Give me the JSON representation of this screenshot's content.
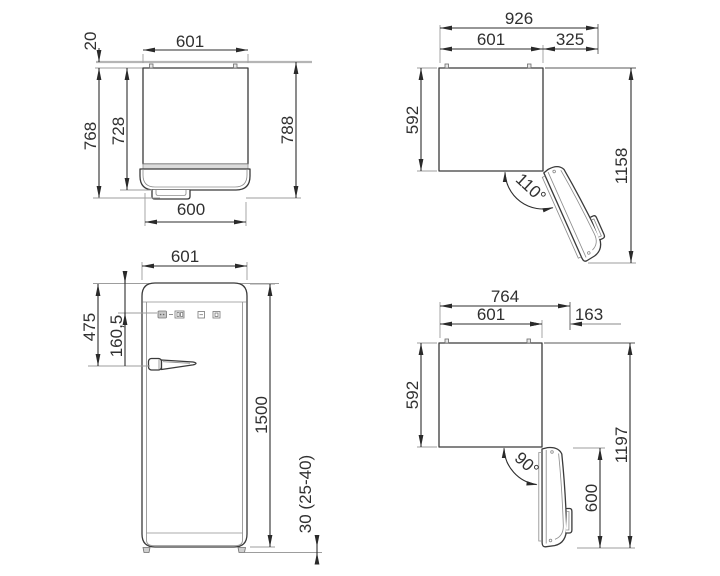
{
  "colors": {
    "line": "#3a3a3a",
    "dimension_line": "#2d2d2d",
    "extension_line": "#9d9d9d",
    "wall_line": "#b5b5b5",
    "band_fill": "#dcdcdc",
    "text": "#303030",
    "background": "#ffffff"
  },
  "views": {
    "top_closed": {
      "dims": {
        "width_top": "601",
        "wall_gap": "20",
        "depth_overall": "768",
        "depth_body": "728",
        "depth_with_clearance": "788",
        "width_bottom": "600"
      }
    },
    "top_open_110": {
      "dims": {
        "overall_width": "926",
        "body_width": "601",
        "door_clearance": "325",
        "body_depth": "592",
        "overall_depth": "1158",
        "door_angle": "110°"
      }
    },
    "front": {
      "dims": {
        "width": "601",
        "handle_from_top": "475",
        "panel_from_top": "160,5",
        "total_height": "1500",
        "feet_height": "30 (25-40)"
      }
    },
    "top_open_90": {
      "dims": {
        "overall_width": "764",
        "body_width": "601",
        "door_clearance": "163",
        "body_depth": "592",
        "overall_depth": "1197",
        "door_depth": "600",
        "door_angle": "90°"
      }
    }
  }
}
